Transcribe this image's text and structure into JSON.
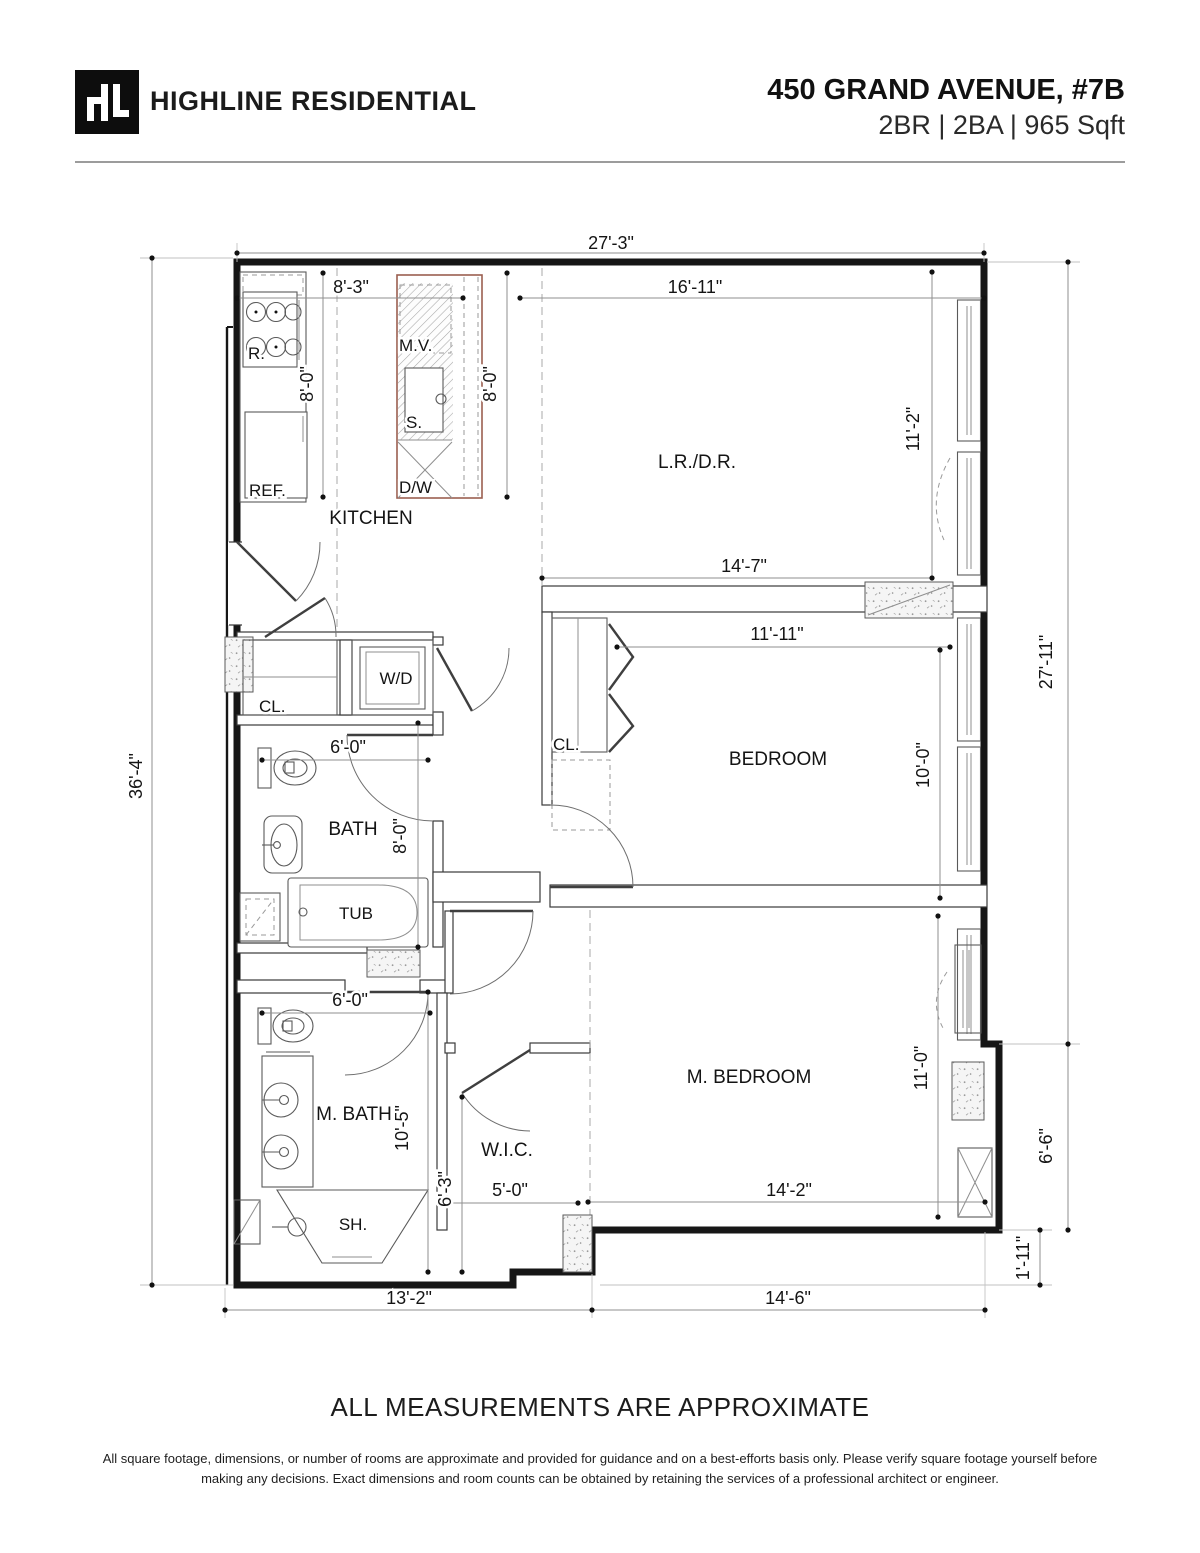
{
  "header": {
    "logo_text": "HL",
    "company": "HIGHLINE RESIDENTIAL",
    "address": "450 GRAND AVENUE, #7B",
    "specs": "2BR | 2BA | 965 Sqft"
  },
  "plan": {
    "rooms": {
      "kitchen": "KITCHEN",
      "living": "L.R./D.R.",
      "bedroom": "BEDROOM",
      "master_bedroom": "M. BEDROOM",
      "bath": "BATH",
      "master_bath": "M. BATH",
      "wic": "W.I.C.",
      "closet_hall": "CL.",
      "closet_bedroom": "CL.",
      "washer_dryer": "W/D",
      "tub": "TUB",
      "shower": "SH.",
      "fridge": "REF.",
      "range": "R.",
      "microwave": "M.V.",
      "sink": "S.",
      "dishwasher": "D/W"
    },
    "dims": {
      "overall_top": "27'-3\"",
      "kitchen_top": "8'-3\"",
      "living_top": "16'-11\"",
      "kitchen_left_run": "8'-0\"",
      "kitchen_right_run": "8'-0\"",
      "living_depth": "11'-2\"",
      "overall_left": "36'-4\"",
      "overall_right": "27'-11\"",
      "hall_top": "14'-7\"",
      "bedroom_width": "11'-11\"",
      "bedroom_depth": "10'-0\"",
      "bath_width": "6'-0\"",
      "bath_depth": "8'-0\"",
      "mbath_width": "6'-0\"",
      "mbath_depth": "10'-5\"",
      "wic_depth": "6'-3\"",
      "wic_width": "5'-0\"",
      "mbedroom_width": "14'-2\"",
      "mbedroom_depth": "11'-0\"",
      "right_lower": "6'-6\"",
      "right_step": "1'-11\"",
      "bottom_left": "13'-2\"",
      "bottom_right": "14'-6\""
    }
  },
  "footer": {
    "title": "ALL MEASUREMENTS ARE APPROXIMATE",
    "disclaimer": "All square footage, dimensions, or number of rooms are approximate and provided for guidance and on a best-efforts basis only. Please verify square footage yourself before making any decisions. Exact dimensions and room counts can be obtained by retaining the services of a professional architect or engineer."
  }
}
